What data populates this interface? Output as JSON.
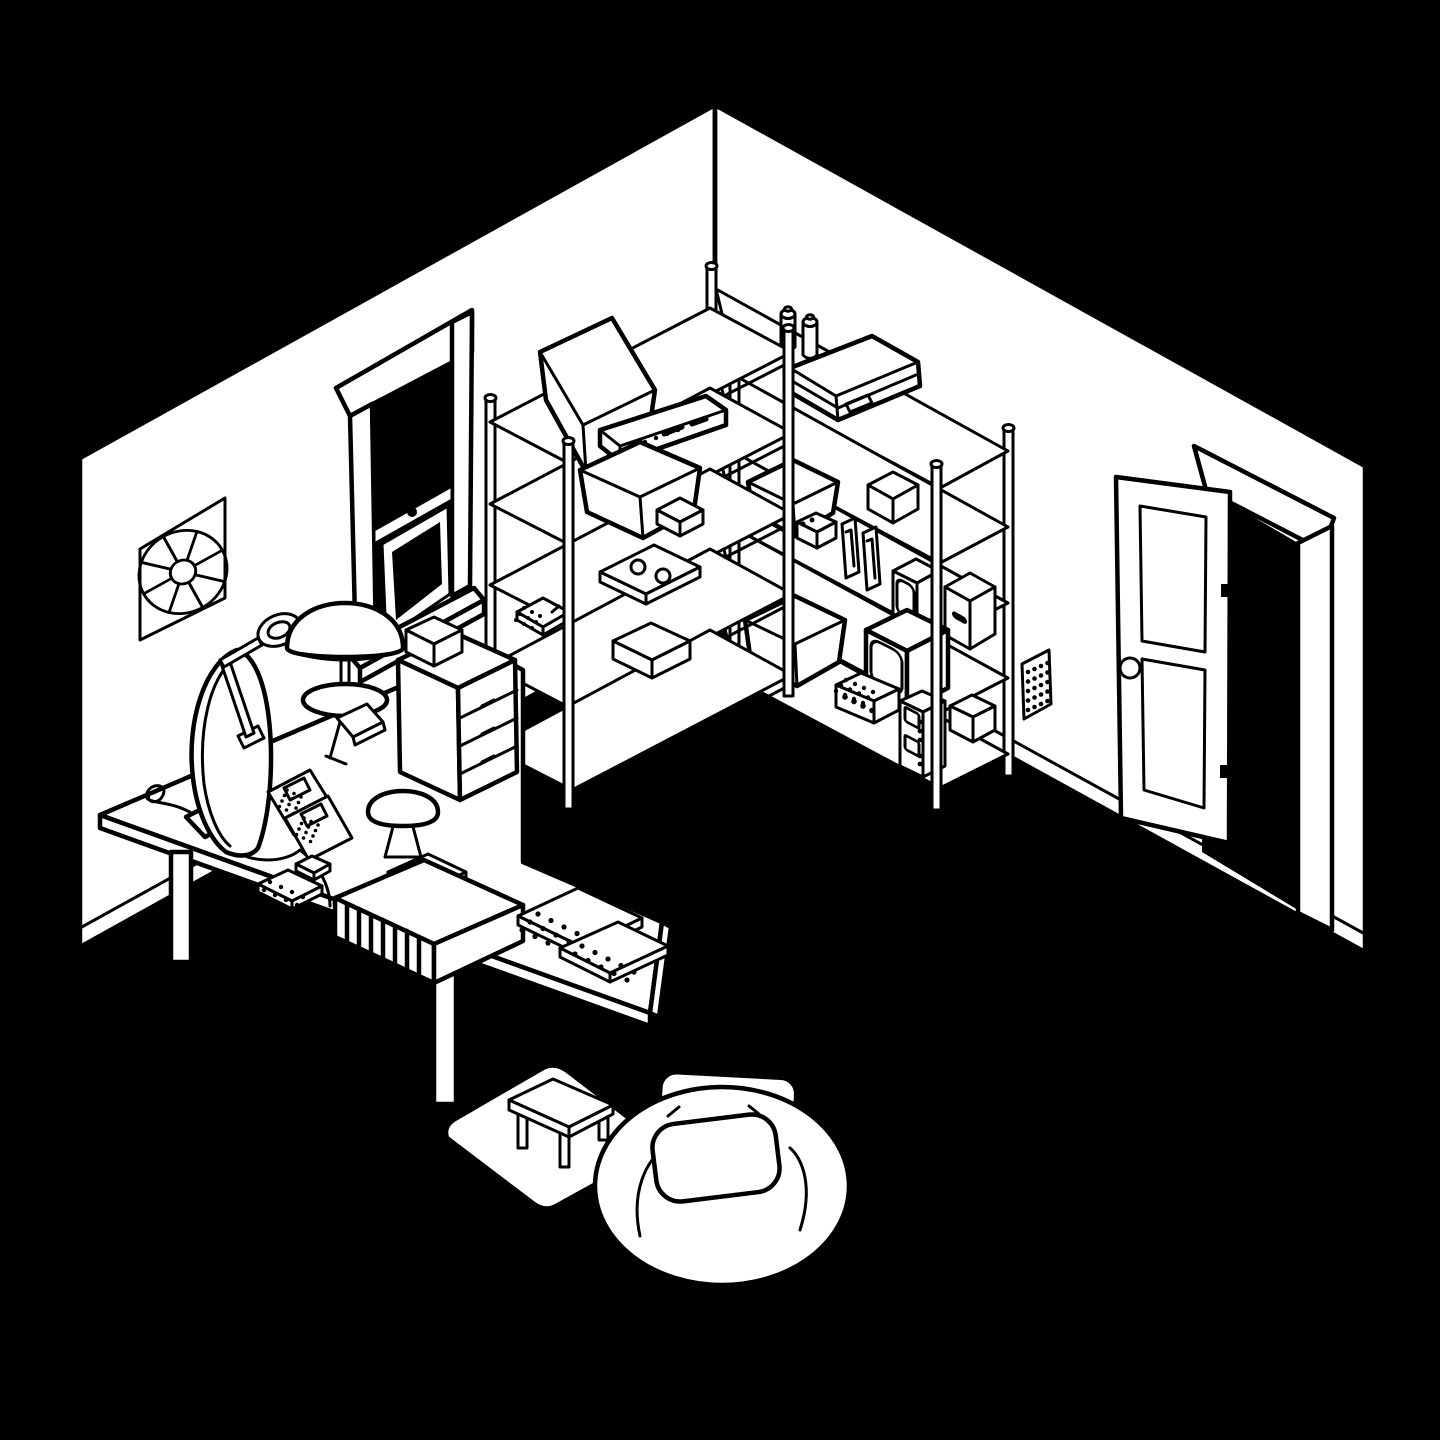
{
  "meta": {
    "title": "Black-and-white isometric cutaway illustration of a corner hobby room",
    "canvas_width": 1440,
    "canvas_height": 1440,
    "style": "hand-drawn line art, white surfaces with black outlines on a black floor"
  },
  "scene": {
    "colors": {
      "bg": "#000000",
      "paper": "#ffffff",
      "ink": "#000000"
    },
    "room": {
      "left_wall_items": [
        "wall-fan with eight radial blades",
        "double-hung window with dark panes, header board and sill"
      ],
      "right_wall_items": [
        "open paneled door with round knob and dark doorway",
        "small dotted vent grille near the floor"
      ]
    },
    "shelving_left_unit": {
      "type": "wire shelving rack, 5 shelves, round posts",
      "items": [
        "open storage tub on top",
        "stereo receiver with button row",
        "wide open bin",
        "small closed box",
        "flat slab with two reels",
        "small dotted keypad",
        "closed box on bottom shelf"
      ]
    },
    "shelving_right_unit": {
      "type": "wire shelving rack, 5 shelves, round posts",
      "items": [
        "flat briefcase on top",
        "two spray cans at the corner",
        "open storage bin",
        "closed box",
        "small camera box with two dots",
        "two bookend slabs",
        "small CRT monitor",
        "cardboard box with handle hole",
        "large CRT television",
        "large open bin",
        "perforated breadboard brick",
        "oscilloscope stack with two screens and knobs",
        "small box on bottom shelf"
      ]
    },
    "desk": {
      "type": "white standing desk with two rectangular legs",
      "items": [
        "flat-screen monitor seen from behind with foot and cables",
        "articulated magnifier lamp clamped to the desk",
        "dome mushroom desk lamp on round base",
        "small book stand",
        "two circuit boards with dotted chips",
        "two small dotted keypads",
        "grille-front synthesizer box",
        "three dotted keyboards",
        "small mushroom night light",
        "desktop drawer organizer with four drawers and a small box on top",
        "loose squiggled cable"
      ]
    },
    "floor": {
      "items": [
        "white area rug",
        "small four-legged wooden bench",
        "large bean bag with pillow and back cushion"
      ]
    }
  }
}
